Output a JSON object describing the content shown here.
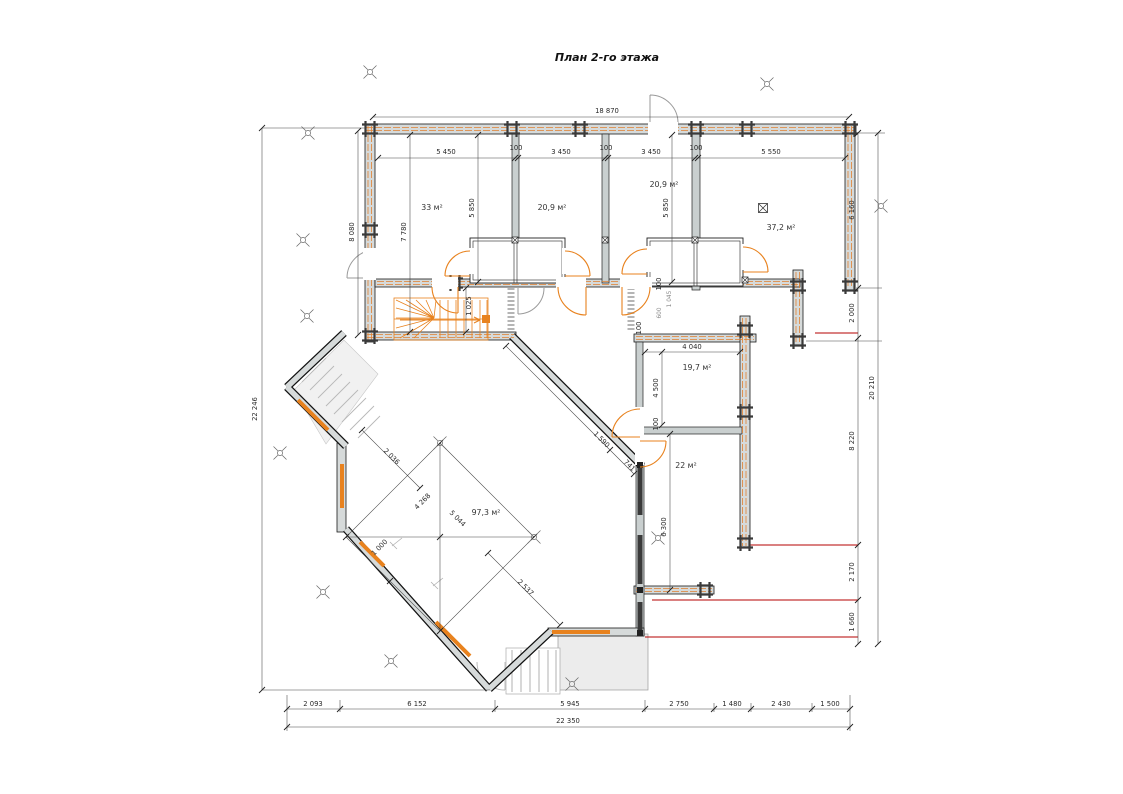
{
  "title": "План 2-го этажа",
  "colors": {
    "wall_gray": "#d6dada",
    "log_orange": "#e08030",
    "window_orange": "#e8821e",
    "marker_red": "#b40000"
  },
  "annotations": {
    "room_areas": [
      {
        "text": "33 м²",
        "x": 432,
        "y": 210,
        "rot": 0
      },
      {
        "text": "20,9 м²",
        "x": 552,
        "y": 210,
        "rot": 0
      },
      {
        "text": "20,9 м²",
        "x": 664,
        "y": 187,
        "rot": 0
      },
      {
        "text": "37,2 м²",
        "x": 781,
        "y": 230,
        "rot": 0
      },
      {
        "text": "19,7 м²",
        "x": 697,
        "y": 370,
        "rot": 0
      },
      {
        "text": "22 м²",
        "x": 686,
        "y": 468,
        "rot": 0
      },
      {
        "text": "97,3 м²",
        "x": 486,
        "y": 515,
        "rot": 0
      }
    ],
    "dimensions": [
      {
        "text": "18 870",
        "x": 607,
        "y": 113,
        "rot": 0
      },
      {
        "text": "5 450",
        "x": 446,
        "y": 154,
        "rot": 0
      },
      {
        "text": "100",
        "x": 516,
        "y": 150,
        "rot": 0
      },
      {
        "text": "3 450",
        "x": 561,
        "y": 154,
        "rot": 0
      },
      {
        "text": "100",
        "x": 606,
        "y": 150,
        "rot": 0
      },
      {
        "text": "3 450",
        "x": 651,
        "y": 154,
        "rot": 0
      },
      {
        "text": "100",
        "x": 696,
        "y": 150,
        "rot": 0
      },
      {
        "text": "5 550",
        "x": 771,
        "y": 154,
        "rot": 0
      },
      {
        "text": "22 246",
        "x": 257,
        "y": 409,
        "rot": -90
      },
      {
        "text": "8 080",
        "x": 354,
        "y": 232,
        "rot": -90
      },
      {
        "text": "7 780",
        "x": 406,
        "y": 232,
        "rot": -90
      },
      {
        "text": "5 850",
        "x": 474,
        "y": 208,
        "rot": -90
      },
      {
        "text": "5 850",
        "x": 668,
        "y": 208,
        "rot": -90
      },
      {
        "text": "6 160",
        "x": 854,
        "y": 210,
        "rot": -90
      },
      {
        "text": "2 000",
        "x": 854,
        "y": 313,
        "rot": -90
      },
      {
        "text": "20 210",
        "x": 874,
        "y": 388,
        "rot": -90
      },
      {
        "text": "8 220",
        "x": 854,
        "y": 441,
        "rot": -90
      },
      {
        "text": "2 170",
        "x": 854,
        "y": 572,
        "rot": -90
      },
      {
        "text": "1 660",
        "x": 854,
        "y": 622,
        "rot": -90
      },
      {
        "text": "4 040",
        "x": 692,
        "y": 349,
        "rot": 0
      },
      {
        "text": "4 500",
        "x": 658,
        "y": 388,
        "rot": -90
      },
      {
        "text": "6 300",
        "x": 666,
        "y": 527,
        "rot": -90
      },
      {
        "text": "100",
        "x": 641,
        "y": 328,
        "rot": -90
      },
      {
        "text": "100",
        "x": 658,
        "y": 424,
        "rot": -90
      },
      {
        "text": "100",
        "x": 661,
        "y": 284,
        "rot": -90
      },
      {
        "text": "1 025",
        "x": 471,
        "y": 306,
        "rot": -90
      },
      {
        "text": "2 036",
        "x": 390,
        "y": 458,
        "rot": 45
      },
      {
        "text": "4 268",
        "x": 424,
        "y": 503,
        "rot": -45
      },
      {
        "text": "5 044",
        "x": 456,
        "y": 520,
        "rot": 45
      },
      {
        "text": "1 000",
        "x": 381,
        "y": 549,
        "rot": -45
      },
      {
        "text": "2 537",
        "x": 524,
        "y": 589,
        "rot": 45
      },
      {
        "text": "1 590",
        "x": 600,
        "y": 441,
        "rot": 45
      },
      {
        "text": "741",
        "x": 628,
        "y": 467,
        "rot": 45
      },
      {
        "text": "2 093",
        "x": 313,
        "y": 706,
        "rot": 0
      },
      {
        "text": "6 152",
        "x": 417,
        "y": 706,
        "rot": 0
      },
      {
        "text": "5 945",
        "x": 570,
        "y": 706,
        "rot": 0
      },
      {
        "text": "2 750",
        "x": 679,
        "y": 706,
        "rot": 0
      },
      {
        "text": "1 480",
        "x": 732,
        "y": 706,
        "rot": 0
      },
      {
        "text": "2 430",
        "x": 781,
        "y": 706,
        "rot": 0
      },
      {
        "text": "1 500",
        "x": 830,
        "y": 706,
        "rot": 0
      },
      {
        "text": "22 350",
        "x": 568,
        "y": 723,
        "rot": 0
      }
    ],
    "small_notes": [
      {
        "text": "1 045",
        "x": 671,
        "y": 299,
        "rot": -90
      },
      {
        "text": "600",
        "x": 661,
        "y": 313,
        "rot": -90
      }
    ]
  }
}
